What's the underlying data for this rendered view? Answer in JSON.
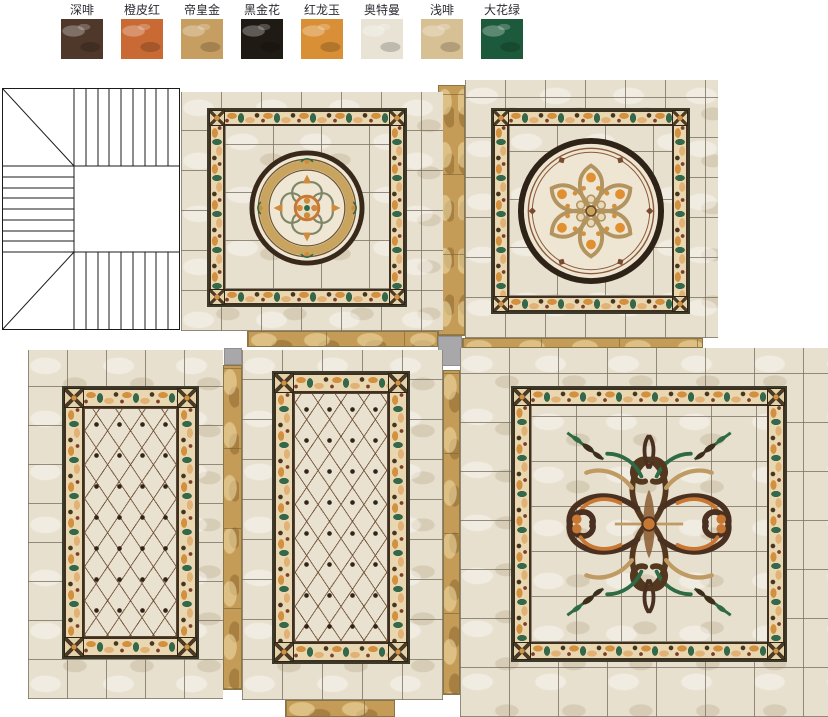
{
  "legend": {
    "items": [
      {
        "label": "深啡",
        "color": "#4f382a"
      },
      {
        "label": "橙皮红",
        "color": "#c96a35"
      },
      {
        "label": "帝皇金",
        "color": "#c79e62"
      },
      {
        "label": "黑金花",
        "color": "#201a14"
      },
      {
        "label": "红龙玉",
        "color": "#d98f35"
      },
      {
        "label": "奥特曼",
        "color": "#e8e3d5"
      },
      {
        "label": "浅啡",
        "color": "#d8c095"
      },
      {
        "label": "大花绿",
        "color": "#1d5a3c"
      }
    ]
  },
  "palette": {
    "page_bg": "#ffffff",
    "tile_beige": "#e8e0cf",
    "tile_grout": "#7d7363",
    "gold_strip": "#c49b57",
    "border_cream": "#e9d7b2",
    "border_green": "#35684a",
    "border_orange": "#d3903f",
    "border_dark": "#3e3121",
    "lattice_line": "#6b4a2e",
    "connector_gray": "#a8a8aa",
    "stair_line": "#1b1b1b"
  }
}
